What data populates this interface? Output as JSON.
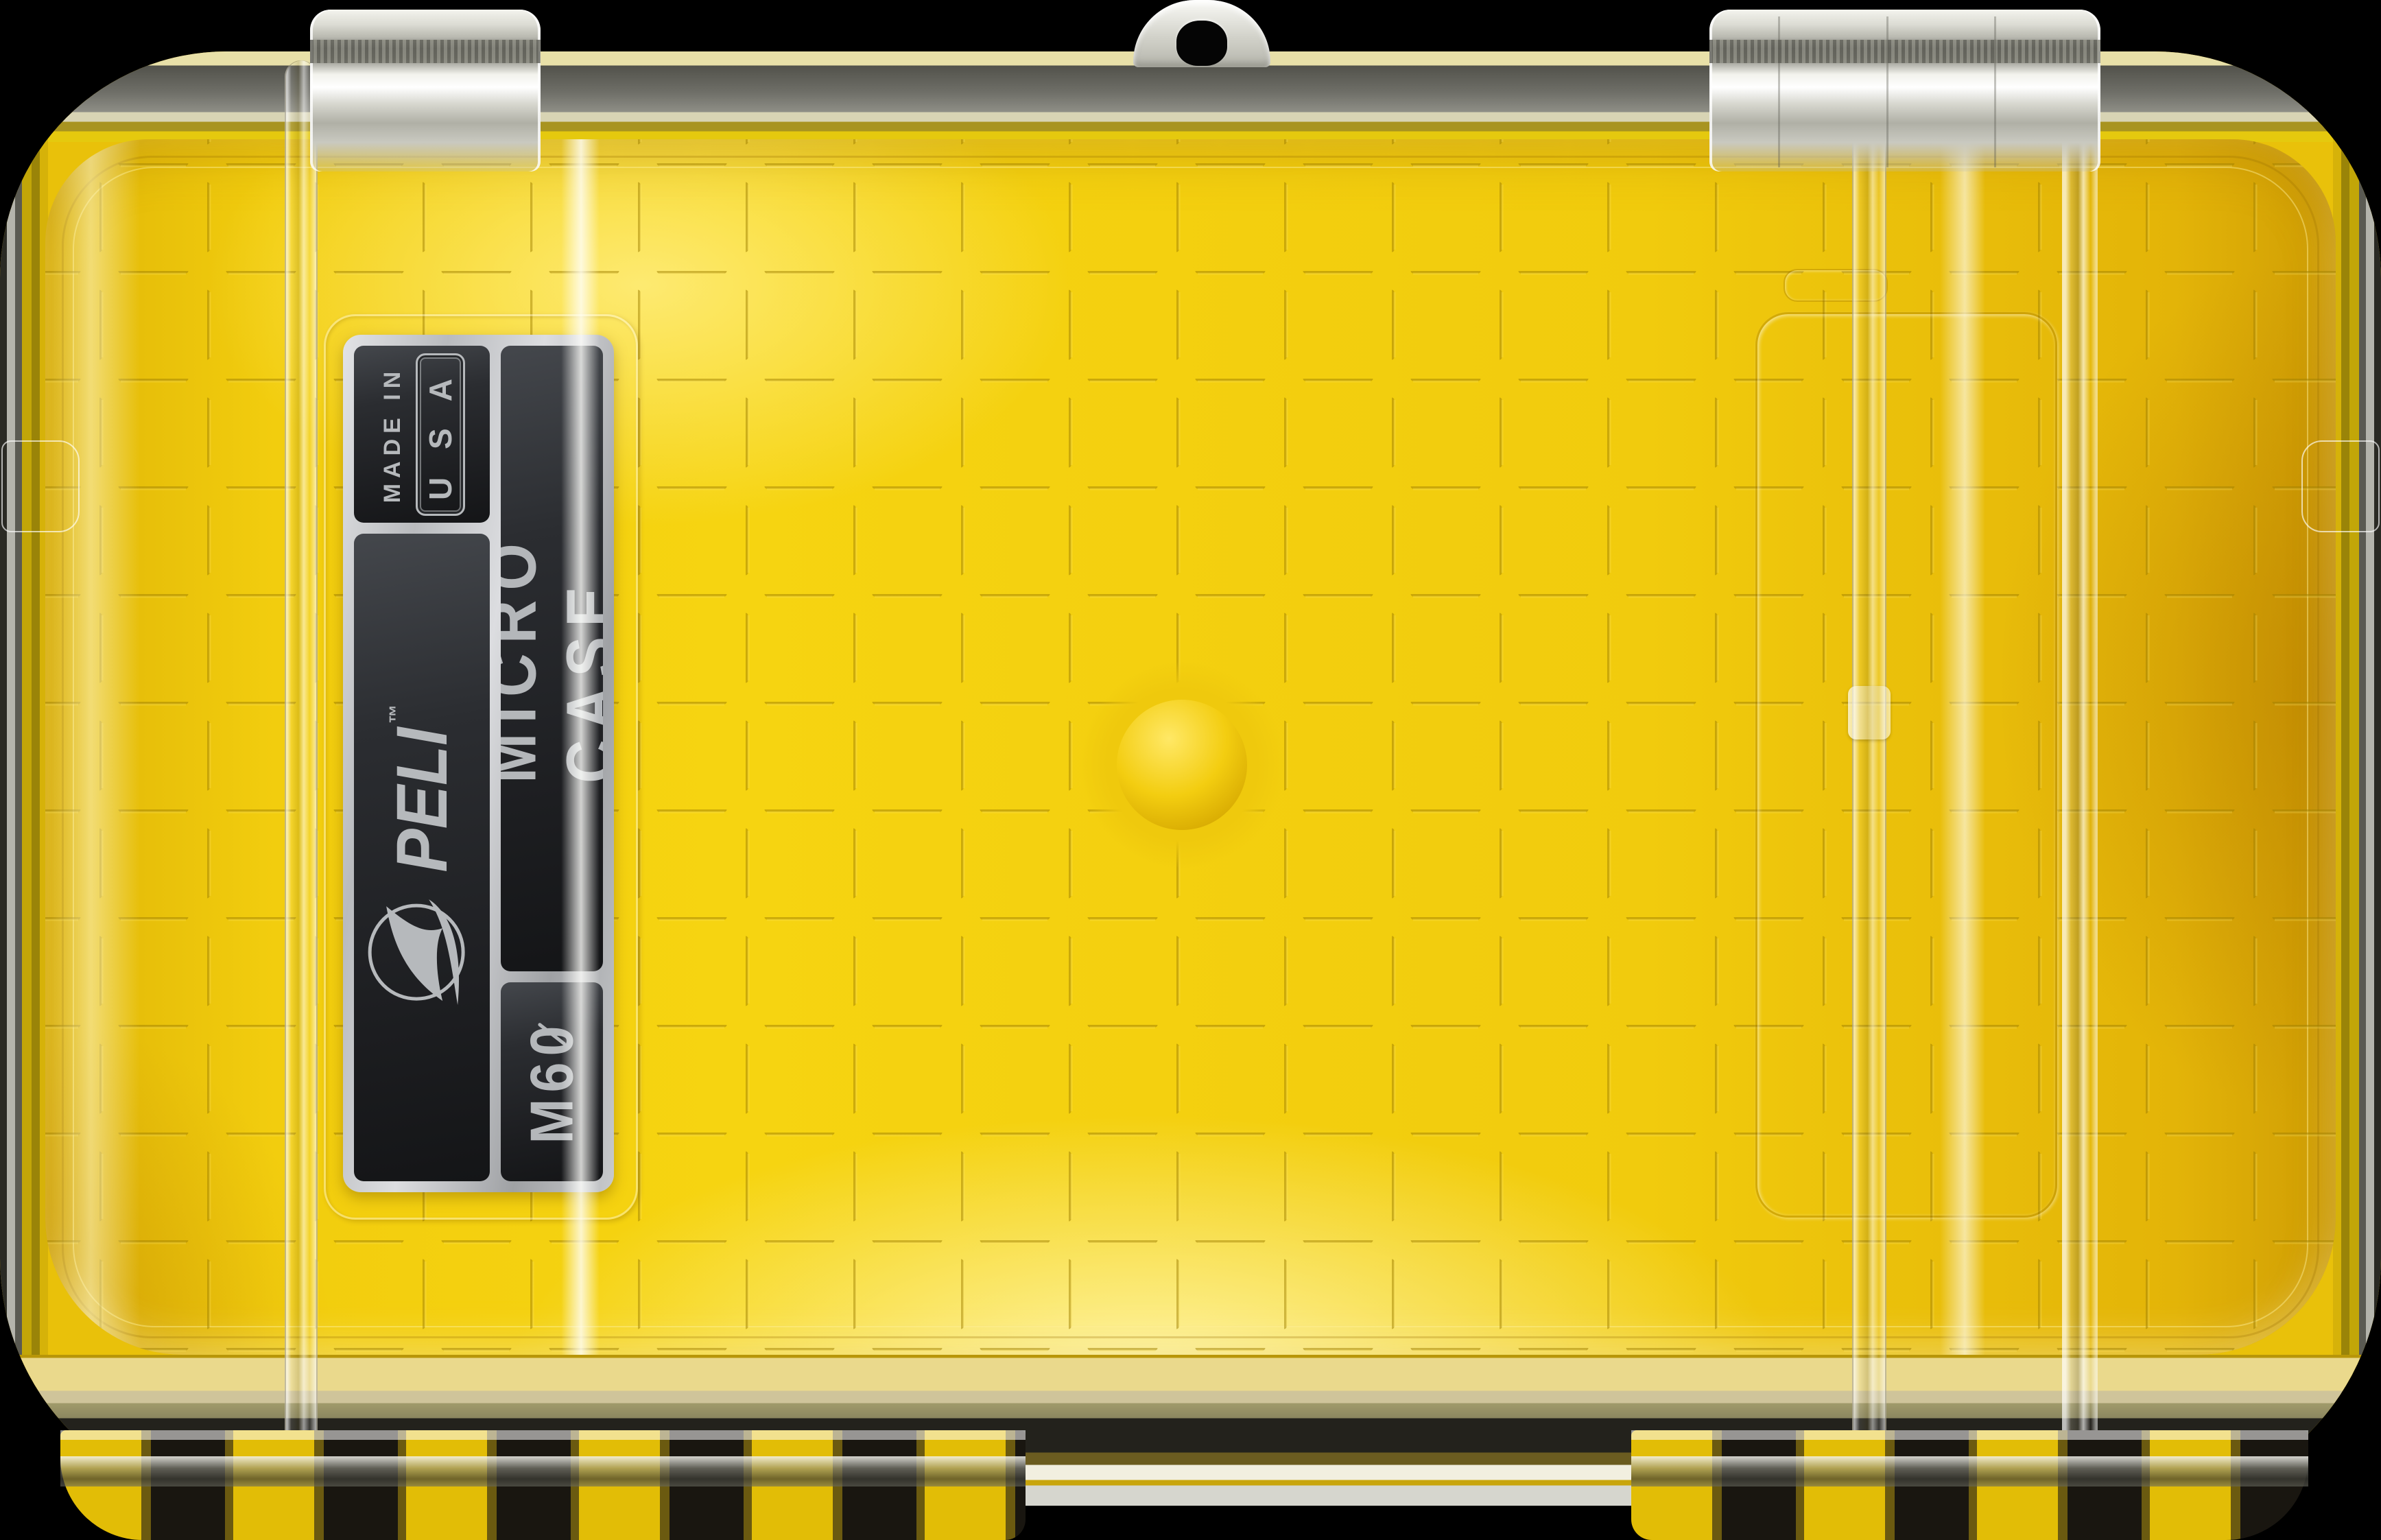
{
  "scene": {
    "background_color": "#000000",
    "subject": "yellow micro case with clear lid, top view"
  },
  "label": {
    "made_in": "MADE IN",
    "usa_badge": "U S A",
    "brand": "PELI",
    "trademark": "™",
    "product_line": "MICRO CASE",
    "model": "M60",
    "model_zero_slashed": true,
    "text_orientation": "rotated-90-ccw"
  },
  "icons": {
    "peli_emblem": "pelican-swoosh-in-circle-icon",
    "lanyard_eyelet": "lanyard-loop",
    "grid": "dashed-square-grid-pattern"
  },
  "colors": {
    "case_yellow": "#F2CD0E",
    "yellow_highlight": "#FFE96E",
    "yellow_deep": "#D8A606",
    "grid_line": "#A08000",
    "label_background": "#1D1E21",
    "label_silver": "#C3C5C8",
    "label_text": "#B6B9BC",
    "rim_gray": "#8E8E86",
    "clear_highlight": "#F5F5EF",
    "background": "#000000"
  }
}
